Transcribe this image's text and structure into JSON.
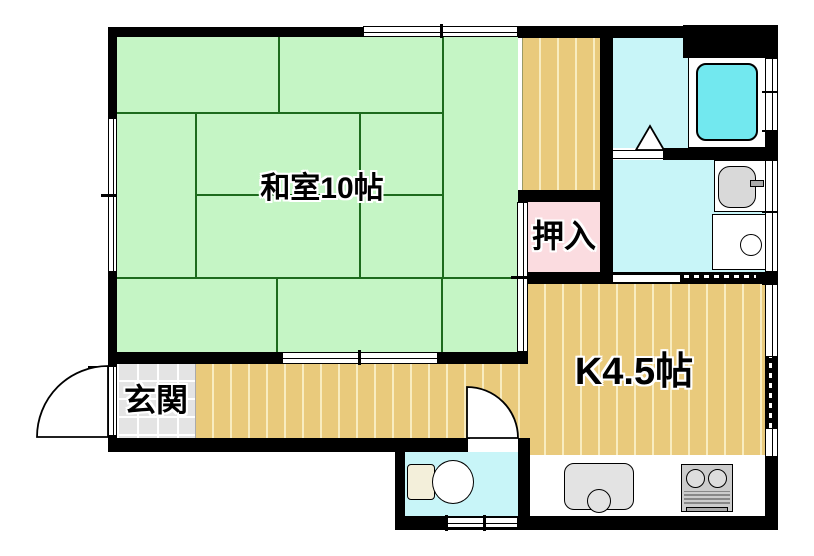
{
  "plan": {
    "type": "floor-plan",
    "rooms": {
      "washitsu": {
        "label": "和室10帖"
      },
      "oshiire": {
        "label": "押入"
      },
      "genkan": {
        "label": "玄関"
      },
      "kitchen": {
        "label": "K4.5帖"
      }
    },
    "fixtures": [
      "bathtub",
      "wash-basin",
      "washing-machine",
      "toilet-seat",
      "kitchen-sink",
      "gas-stove",
      "entrance-door-swing",
      "toilet-door-swing",
      "bath-folding-door"
    ]
  },
  "colors": {
    "wall": "#000000",
    "tatami": "#c5f5c5",
    "tatami-line": "#1d6b1d",
    "wood": "#e9ca7c",
    "wood-stripe": "#f8ecc0",
    "closet-pink": "#fbdce0",
    "water-cyan": "#c8f5f8",
    "bathtub-cyan": "#72e8ef",
    "genkan-tile": "#e4e4e4",
    "fixture-gray": "#d9d9d9"
  }
}
